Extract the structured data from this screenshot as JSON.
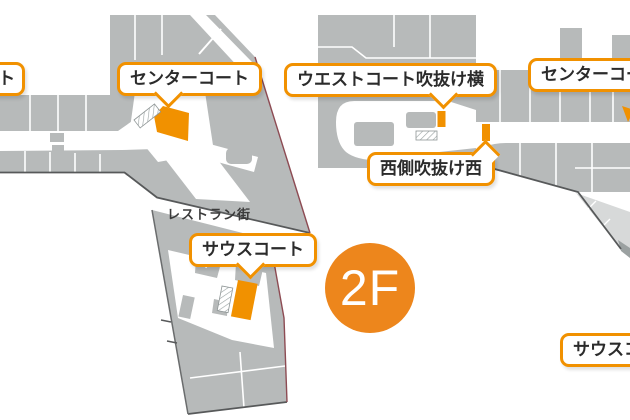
{
  "floor_badge": {
    "label": "2F"
  },
  "map_texts": {
    "restaurant_street": "レストラン街"
  },
  "callouts": [
    {
      "id": "north-court",
      "label": "ノースコート"
    },
    {
      "id": "center-court-west",
      "label": "センターコート"
    },
    {
      "id": "west-court-atrium-side",
      "label": "ウエストコート吹抜け横"
    },
    {
      "id": "west-side-atrium-west",
      "label": "西側吹抜け西"
    },
    {
      "id": "center-court-east",
      "label": "センターコート"
    },
    {
      "id": "south-court-west",
      "label": "サウスコート"
    },
    {
      "id": "south-court-east",
      "label": "サウスコート"
    }
  ],
  "colors": {
    "accent_orange": "#F19100",
    "badge_orange": "#ED861C",
    "building_gray": "#B7BABA",
    "light_gray": "#D7D9D9",
    "outline_dark": "#57595A",
    "edge_maroon": "#8D4B53",
    "label_text": "#2B2B2B"
  }
}
